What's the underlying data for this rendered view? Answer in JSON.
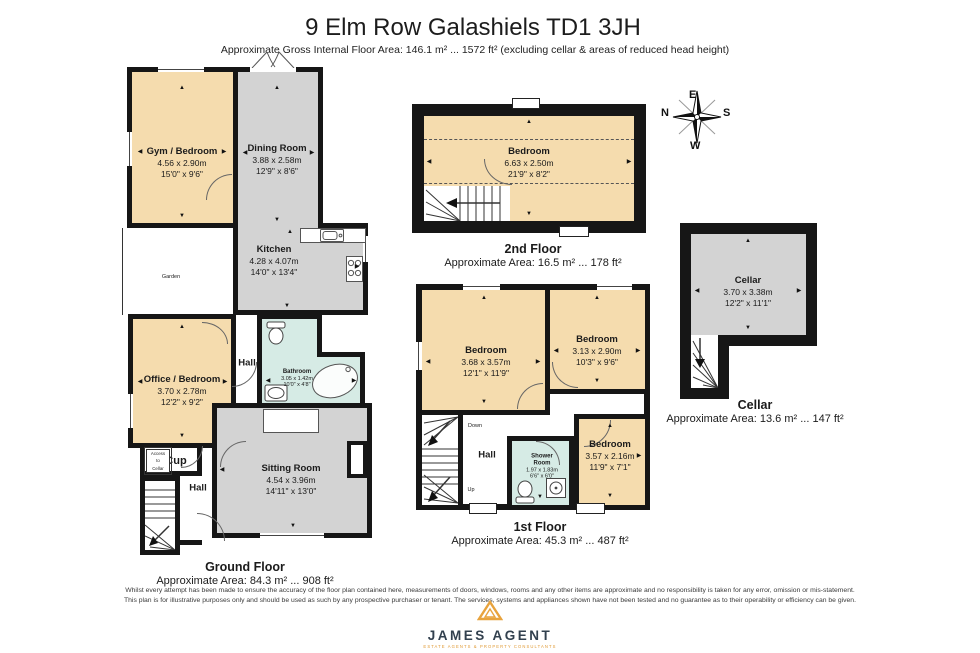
{
  "title": "9 Elm Row Galashiels TD1 3JH",
  "subtitle": "Approximate Gross Internal Floor Area: 146.1 m² ... 1572 ft² (excluding cellar & areas of reduced head height)",
  "compass": {
    "n": "N",
    "e": "E",
    "s": "S",
    "w": "W"
  },
  "colors": {
    "room_tan": "#f5dcae",
    "room_grey": "#d3d3d3",
    "room_blue": "#d6ebe5",
    "wall": "#161616",
    "logo_orange": "#e09a35",
    "logo_navy": "#32404e"
  },
  "floors": {
    "ground": {
      "label": "Ground Floor",
      "area": "Approximate Area: 84.3 m² ... 908 ft²",
      "rooms": {
        "gym": {
          "name": "Gym / Bedroom",
          "m": "4.56 x 2.90m",
          "ft": "15'0\" x 9'6\""
        },
        "dining": {
          "name": "Dining Room",
          "m": "3.88 x 2.58m",
          "ft": "12'9\" x 8'6\""
        },
        "kitchen": {
          "name": "Kitchen",
          "m": "4.28 x 4.07m",
          "ft": "14'0\" x 13'4\""
        },
        "office": {
          "name": "Office / Bedroom",
          "m": "3.70 x 2.78m",
          "ft": "12'2\" x 9'2\""
        },
        "bathroom": {
          "name": "Bathroom",
          "m": "3.05 x 1.42m",
          "ft": "10'0\" x 4'8\""
        },
        "sitting": {
          "name": "Sitting Room",
          "m": "4.54 x 3.96m",
          "ft": "14'11\" x 13'0\""
        },
        "hall_upper": "Hall",
        "hall_lower": "Hall",
        "cup": "Cup",
        "garden": "Garden",
        "access_line1": "Access",
        "access_line2": "to",
        "access_line3": "Cellar"
      }
    },
    "second": {
      "label": "2nd Floor",
      "area": "Approximate Area: 16.5 m² ... 178 ft²",
      "rooms": {
        "bedroom": {
          "name": "Bedroom",
          "m": "6.63 x 2.50m",
          "ft": "21'9\" x 8'2\""
        }
      }
    },
    "first": {
      "label": "1st Floor",
      "area": "Approximate Area: 45.3 m² ... 487 ft²",
      "rooms": {
        "bedroom1": {
          "name": "Bedroom",
          "m": "3.68 x 3.57m",
          "ft": "12'1\" x 11'9\""
        },
        "bedroom2": {
          "name": "Bedroom",
          "m": "3.13 x 2.90m",
          "ft": "10'3\" x 9'6\""
        },
        "bedroom3": {
          "name": "Bedroom",
          "m": "3.57 x 2.16m",
          "ft": "11'9\" x 7'1\""
        },
        "shower": {
          "name1": "Shower",
          "name2": "Room",
          "m": "1.97 x 1.83m",
          "ft": "6'6\" x 6'0\""
        },
        "hall": "Hall",
        "up": "Up",
        "down": "Down"
      }
    },
    "cellar": {
      "label": "Cellar",
      "area": "Approximate Area: 13.6 m² ... 147 ft²",
      "rooms": {
        "cellar": {
          "name": "Cellar",
          "m": "3.70 x 3.38m",
          "ft": "12'2\" x 11'1\""
        }
      }
    }
  },
  "disclaimer": {
    "line1": "Whilst every attempt has been made to ensure the accuracy of the floor plan contained here, measurements of doors, windows, rooms and any other items are approximate and no responsibility is taken for any error, omission or mis-statement.",
    "line2": "This plan is for illustrative purposes only and should be used as such by any prospective purchaser or tenant. The services, systems and appliances shown have not been tested and no guarantee as to their operability or efficiency can be given."
  },
  "logo": {
    "name": "JAMES AGENT",
    "tagline": "ESTATE AGENTS & PROPERTY CONSULTANTS"
  }
}
